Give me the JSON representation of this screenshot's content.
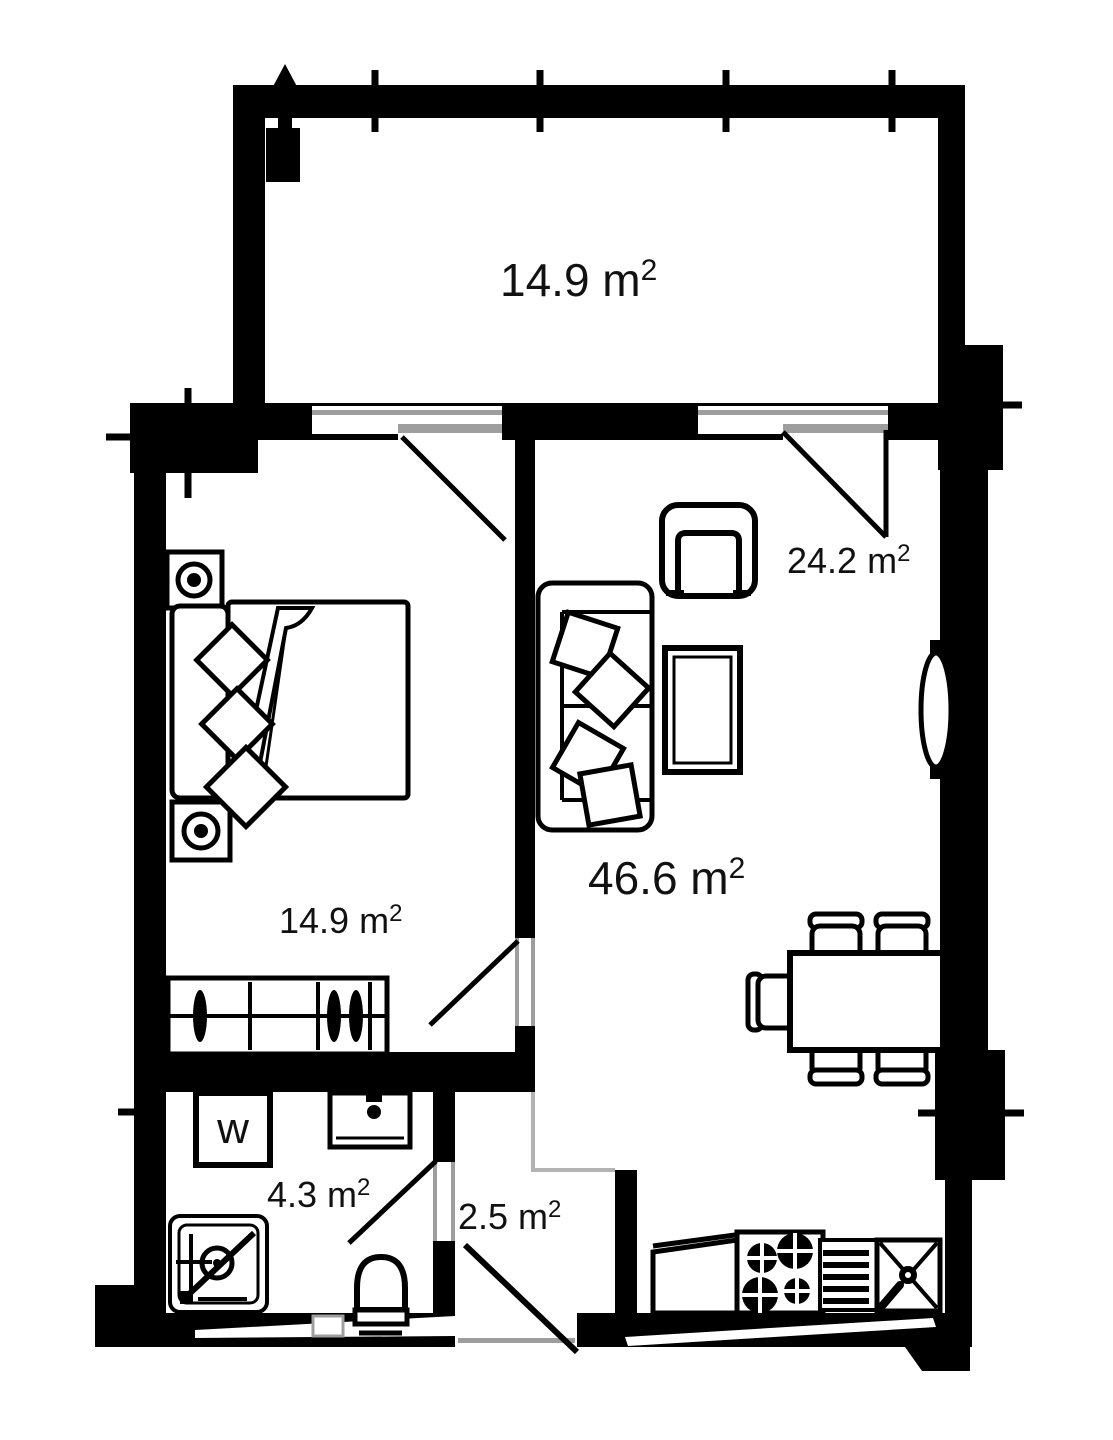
{
  "colors": {
    "wall": "#000000",
    "furniture_stroke": "#000000",
    "frame_gray": "#9e9e9e",
    "boundary_gray": "#b3b3b3",
    "text": "#111111",
    "background": "#ffffff"
  },
  "labels": {
    "balcony": {
      "text": "14.9 m",
      "sup": "2"
    },
    "living": {
      "text": "24.2 m",
      "sup": "2"
    },
    "total": {
      "text": "46.6 m",
      "sup": "2"
    },
    "bedroom": {
      "text": "14.9 m",
      "sup": "2"
    },
    "bathroom": {
      "text": "4.3 m",
      "sup": "2"
    },
    "hallway": {
      "text": "2.5 m",
      "sup": "2"
    }
  },
  "appliances": {
    "washer_label": "w"
  }
}
